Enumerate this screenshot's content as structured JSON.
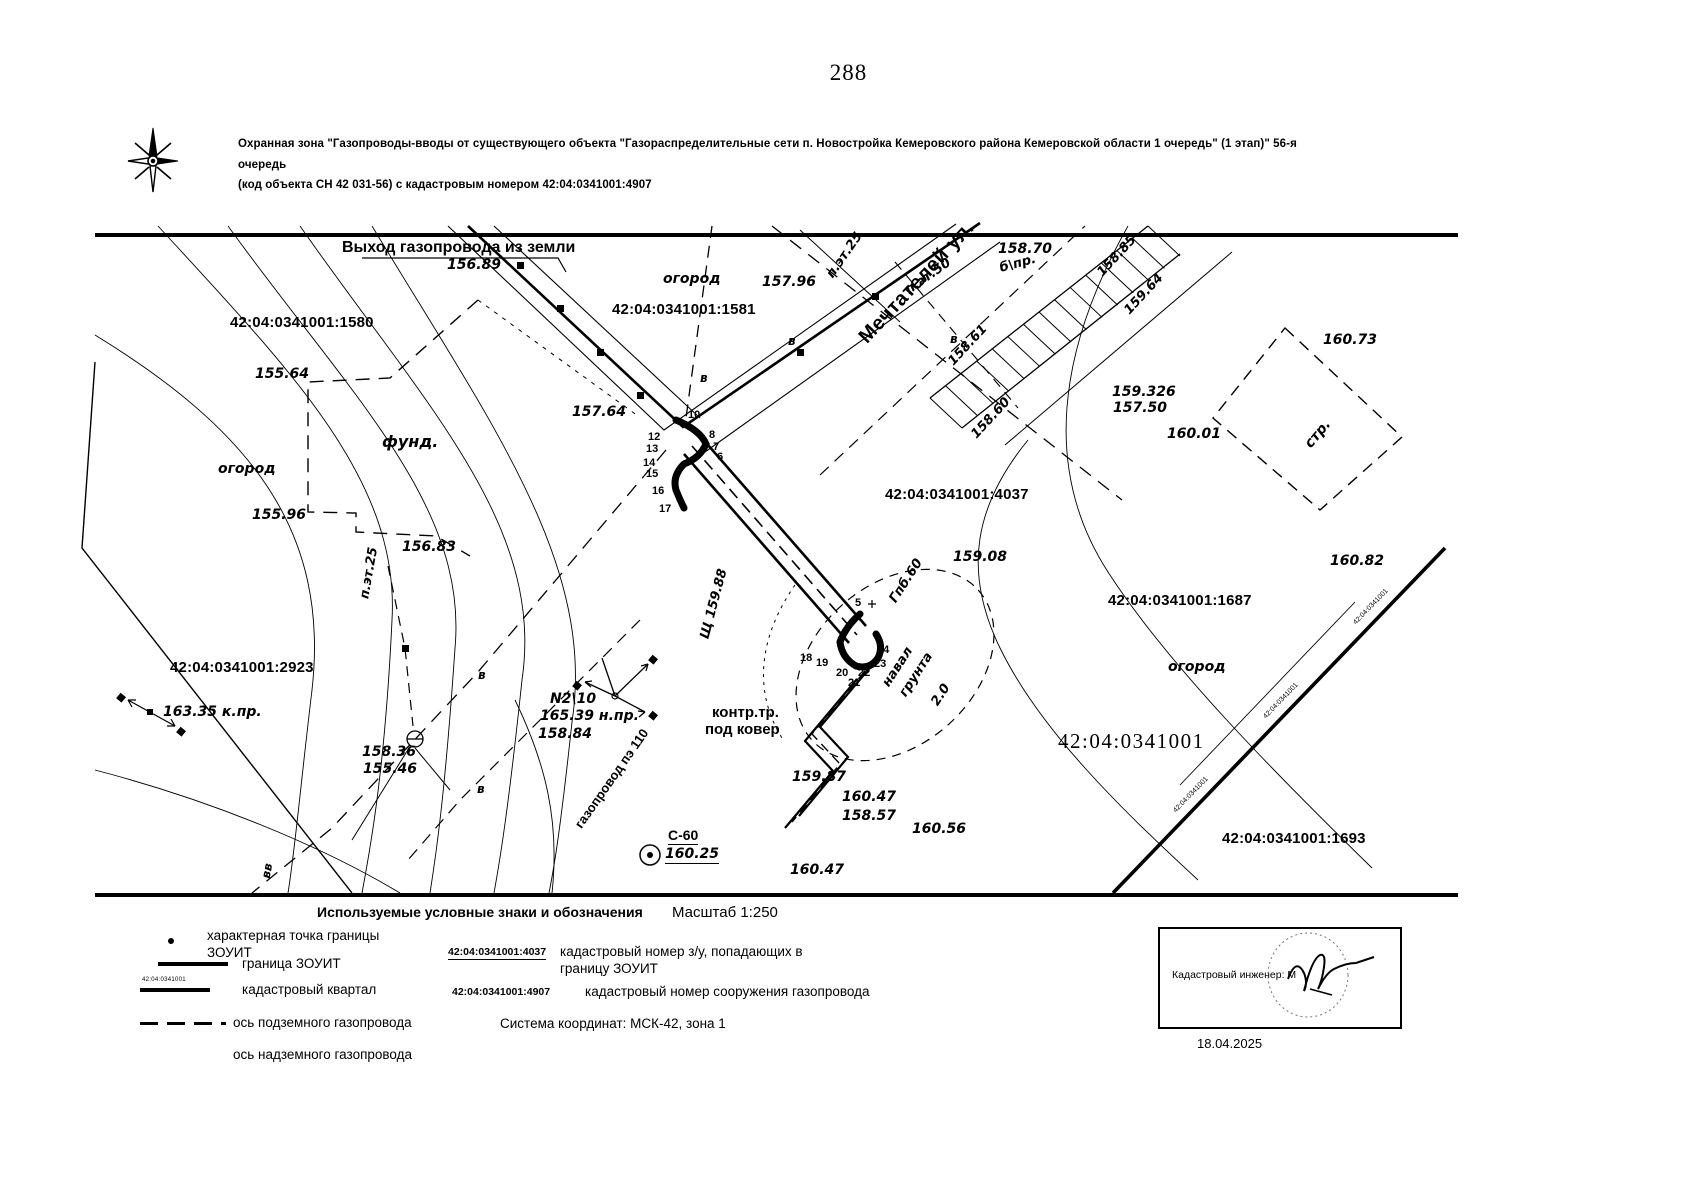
{
  "page": {
    "number": "288"
  },
  "header": {
    "line1": "Охранная зона \"Газопроводы-вводы от существующего объекта \"Газораспределительные сети п. Новостройка Кемеровского района Кемеровской области 1 очередь\" (1 этап)\" 56-я очередь",
    "line2": "(код объекта СН 42 031-56) с кадастровым номером 42:04:0341001:4907"
  },
  "map": {
    "quarter_text": "42:04:0341001",
    "labels": [
      {
        "t": "Выход газопровода из земли",
        "x": 342,
        "y": 240,
        "c": "lbl-b16"
      },
      {
        "t": "156.89",
        "x": 447,
        "y": 258,
        "c": "lbl-i15"
      },
      {
        "t": "огород",
        "x": 663,
        "y": 272,
        "c": "lbl-i15"
      },
      {
        "t": "157.96",
        "x": 762,
        "y": 275,
        "c": "lbl-i15"
      },
      {
        "t": "42:04:0341001:1580",
        "x": 230,
        "y": 315,
        "c": "lbl-k"
      },
      {
        "t": "42:04:0341001:1581",
        "x": 612,
        "y": 302,
        "c": "lbl-k"
      },
      {
        "t": "п.эт.25",
        "x": 830,
        "y": 270,
        "r": -55,
        "c": "lbl-i14"
      },
      {
        "t": "п.эт.50",
        "x": 907,
        "y": 285,
        "r": -35,
        "c": "lbl-i14"
      },
      {
        "t": "158.70",
        "x": 998,
        "y": 242,
        "c": "lbl-i15"
      },
      {
        "t": "б\\пр.",
        "x": 1000,
        "y": 262,
        "r": -15,
        "c": "lbl-i14"
      },
      {
        "t": "Мечтателей ул.",
        "x": 863,
        "y": 330,
        "r": -47,
        "c": "lbl-street"
      },
      {
        "t": "158.85",
        "x": 1100,
        "y": 268,
        "r": -47,
        "c": "lbl-i14"
      },
      {
        "t": "159.64",
        "x": 1127,
        "y": 306,
        "r": -47,
        "c": "lbl-i14"
      },
      {
        "t": "158.61",
        "x": 951,
        "y": 357,
        "r": -47,
        "c": "lbl-i14"
      },
      {
        "t": "158.60",
        "x": 974,
        "y": 430,
        "r": -47,
        "c": "lbl-i14"
      },
      {
        "t": "160.73",
        "x": 1323,
        "y": 333,
        "c": "lbl-i15"
      },
      {
        "t": "стр.",
        "x": 1308,
        "y": 439,
        "r": -50,
        "c": "lbl-i15"
      },
      {
        "t": "155.64",
        "x": 255,
        "y": 367,
        "c": "lbl-i15"
      },
      {
        "t": "фунд.",
        "x": 382,
        "y": 434,
        "c": "lbl-i16"
      },
      {
        "t": "огород",
        "x": 218,
        "y": 462,
        "c": "lbl-i15"
      },
      {
        "t": "157.64",
        "x": 572,
        "y": 405,
        "c": "lbl-i15"
      },
      {
        "t": "155.96",
        "x": 252,
        "y": 508,
        "c": "lbl-i15"
      },
      {
        "t": "156.83",
        "x": 402,
        "y": 540,
        "c": "lbl-i15"
      },
      {
        "t": "п.эт.25",
        "x": 365,
        "y": 592,
        "r": -80,
        "c": "lbl-i14"
      },
      {
        "t": "159.326",
        "x": 1112,
        "y": 385,
        "c": "lbl-i15"
      },
      {
        "t": "157.50",
        "x": 1113,
        "y": 401,
        "c": "lbl-i15"
      },
      {
        "t": "160.01",
        "x": 1167,
        "y": 427,
        "c": "lbl-i15"
      },
      {
        "t": "42:04:0341001:4037",
        "x": 885,
        "y": 487,
        "c": "lbl-k"
      },
      {
        "t": "159.08",
        "x": 953,
        "y": 550,
        "c": "lbl-i15"
      },
      {
        "t": "Гпб.60",
        "x": 893,
        "y": 595,
        "r": -57,
        "c": "lbl-i14"
      },
      {
        "t": "42:04:0341001:1687",
        "x": 1108,
        "y": 593,
        "c": "lbl-k"
      },
      {
        "t": "160.82",
        "x": 1330,
        "y": 554,
        "c": "lbl-i15"
      },
      {
        "t": "огород",
        "x": 1168,
        "y": 660,
        "c": "lbl-i15"
      },
      {
        "t": "42:04:0341001:2923",
        "x": 170,
        "y": 660,
        "c": "lbl-k"
      },
      {
        "t": "163.35 к.пр.",
        "x": 163,
        "y": 705,
        "c": "lbl-i15"
      },
      {
        "t": "Щ 159.88",
        "x": 705,
        "y": 632,
        "r": -75,
        "c": "lbl-i14"
      },
      {
        "t": "158.36",
        "x": 362,
        "y": 745,
        "c": "lbl-i15"
      },
      {
        "t": "155.46",
        "x": 363,
        "y": 762,
        "c": "lbl-i15"
      },
      {
        "t": "N2\\10",
        "x": 550,
        "y": 692,
        "c": "lbl-i15"
      },
      {
        "t": "165.39 н.пр.",
        "x": 540,
        "y": 709,
        "c": "lbl-i15"
      },
      {
        "t": "158.84",
        "x": 538,
        "y": 727,
        "c": "lbl-i15"
      },
      {
        "t": "контр.тр.",
        "x": 712,
        "y": 705,
        "c": "lbl-b15"
      },
      {
        "t": "под ковер",
        "x": 705,
        "y": 722,
        "c": "lbl-b15"
      },
      {
        "t": "навал",
        "x": 886,
        "y": 679,
        "r": -57,
        "c": "lbl-i14"
      },
      {
        "t": "грунта",
        "x": 903,
        "y": 689,
        "r": -57,
        "c": "lbl-i14"
      },
      {
        "t": "2.0",
        "x": 935,
        "y": 698,
        "r": -57,
        "c": "lbl-i14"
      },
      {
        "t": "42:04:0341001",
        "x": 1058,
        "y": 730,
        "c": "lbl-big"
      },
      {
        "t": "159.87",
        "x": 792,
        "y": 770,
        "c": "lbl-i15"
      },
      {
        "t": "160.47",
        "x": 842,
        "y": 790,
        "c": "lbl-i15"
      },
      {
        "t": "158.57",
        "x": 842,
        "y": 809,
        "c": "lbl-i15"
      },
      {
        "t": "160.56",
        "x": 912,
        "y": 822,
        "c": "lbl-i15"
      },
      {
        "t": "С-60",
        "x": 668,
        "y": 828,
        "c": "lbl-u15"
      },
      {
        "t": "160.25",
        "x": 665,
        "y": 847,
        "c": "lbl-iu15"
      },
      {
        "t": "160.47",
        "x": 790,
        "y": 863,
        "c": "lbl-i15"
      },
      {
        "t": "42:04:0341001:1693",
        "x": 1222,
        "y": 831,
        "c": "lbl-k"
      },
      {
        "t": "газопровод пэ 110",
        "x": 578,
        "y": 820,
        "r": -55,
        "c": "lbl-b13"
      },
      {
        "t": "в",
        "x": 788,
        "y": 335,
        "c": "lbl-i13"
      },
      {
        "t": "в",
        "x": 950,
        "y": 333,
        "c": "lbl-i13"
      },
      {
        "t": "в",
        "x": 478,
        "y": 669,
        "c": "lbl-i13"
      },
      {
        "t": "в",
        "x": 477,
        "y": 783,
        "c": "lbl-i13"
      },
      {
        "t": "в",
        "x": 700,
        "y": 372,
        "c": "lbl-i13"
      },
      {
        "t": "вв",
        "x": 266,
        "y": 872,
        "r": -80,
        "c": "lbl-i13"
      }
    ],
    "points": [
      {
        "n": "10",
        "x": 688,
        "y": 410
      },
      {
        "n": "12",
        "x": 648,
        "y": 432
      },
      {
        "n": "13",
        "x": 646,
        "y": 444
      },
      {
        "n": "14",
        "x": 643,
        "y": 458
      },
      {
        "n": "15",
        "x": 646,
        "y": 469
      },
      {
        "n": "16",
        "x": 652,
        "y": 486
      },
      {
        "n": "17",
        "x": 659,
        "y": 504
      },
      {
        "n": "8",
        "x": 709,
        "y": 430
      },
      {
        "n": "7",
        "x": 713,
        "y": 442
      },
      {
        "n": "6",
        "x": 717,
        "y": 452
      },
      {
        "n": "5",
        "x": 855,
        "y": 598
      },
      {
        "n": "18",
        "x": 800,
        "y": 653
      },
      {
        "n": "19",
        "x": 816,
        "y": 658
      },
      {
        "n": "20",
        "x": 836,
        "y": 668
      },
      {
        "n": "21",
        "x": 848,
        "y": 678
      },
      {
        "n": "22",
        "x": 858,
        "y": 668
      },
      {
        "n": "23",
        "x": 874,
        "y": 659
      },
      {
        "n": "14",
        "x": 877,
        "y": 645
      }
    ],
    "markers": [
      [
        520,
        265
      ],
      [
        560,
        308
      ],
      [
        600,
        352
      ],
      [
        640,
        395
      ],
      [
        800,
        352
      ],
      [
        875,
        296
      ],
      [
        405,
        648
      ]
    ]
  },
  "legend": {
    "title": "Используемые условные знаки и обозначения",
    "scale": "Масштаб 1:250",
    "items": [
      {
        "sym": "point",
        "label": "характерная точка границы ЗОУИТ"
      },
      {
        "sym": "thick",
        "label": "граница ЗОУИТ"
      },
      {
        "sym": "quarter",
        "label": "кадастровый квартал"
      },
      {
        "sym": "dash",
        "label": "ось подземного газопровода"
      },
      {
        "sym": "none",
        "label": "ось надземного газопровода"
      }
    ],
    "quarter_sym_text": "42:04:0341001",
    "notes": [
      {
        "num": "42:04:0341001:4037",
        "label": "кадастровый номер з/у, попадающих в границу ЗОУИТ"
      },
      {
        "num": "42:04:0341001:4907",
        "label": "кадастровый  номер сооружения газопровода"
      }
    ],
    "coord_system": "Система координат: МСК-42, зона 1"
  },
  "signature": {
    "engineer": "Кадастровый инженер: М",
    "date": "18.04.2025"
  }
}
